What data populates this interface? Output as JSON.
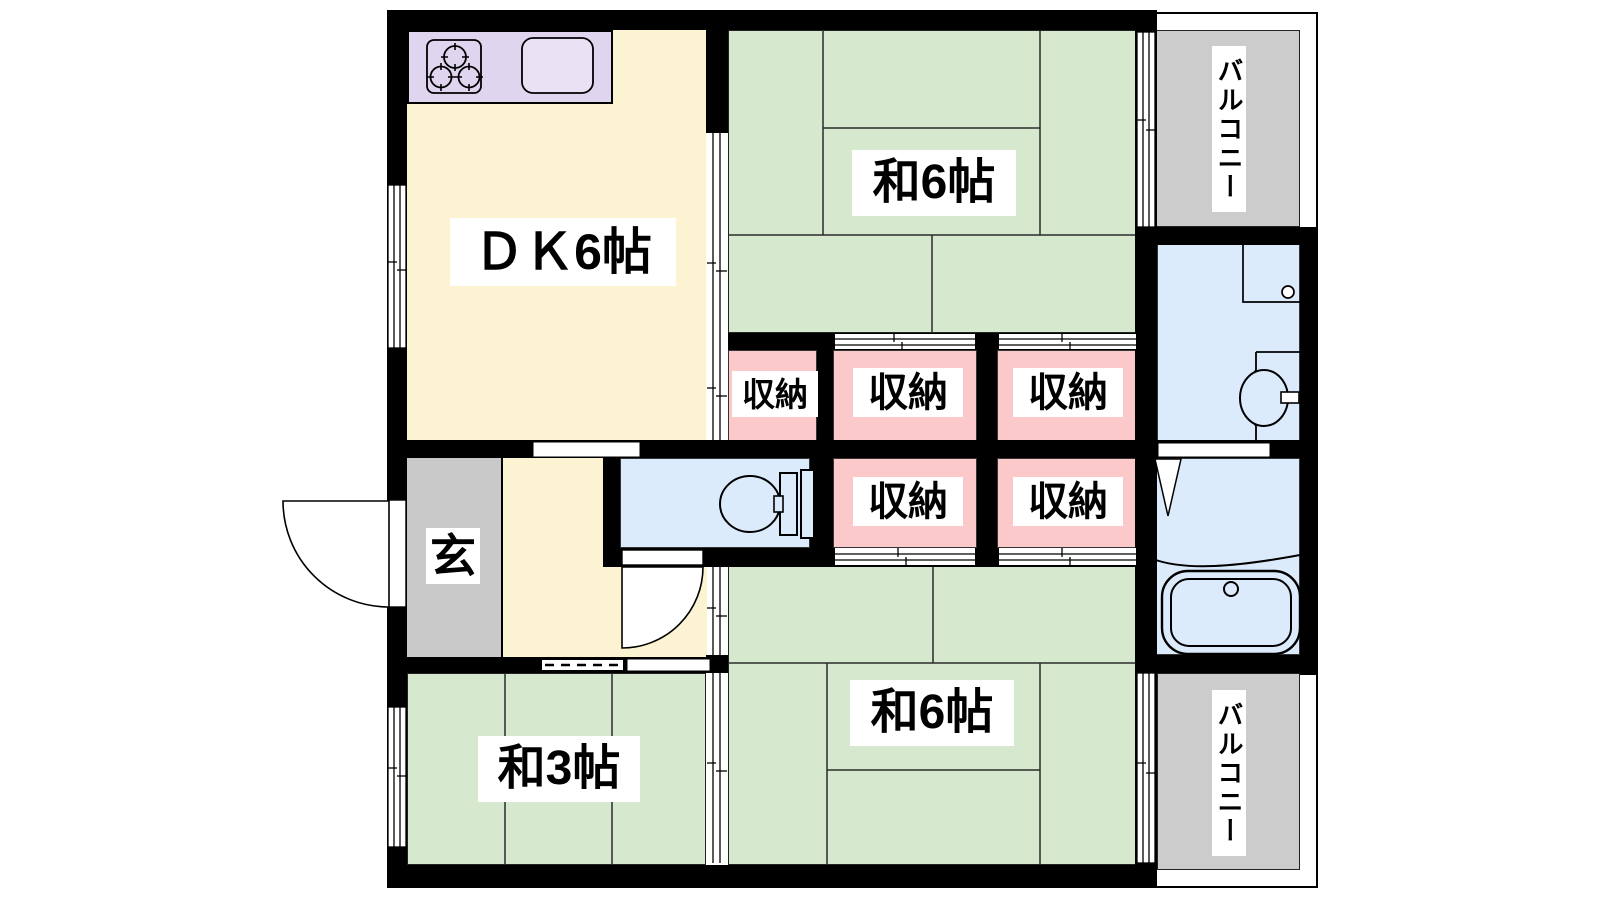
{
  "plan": {
    "title": "2DK apartment floor plan",
    "rooms": {
      "dk": "ＤＫ6帖",
      "wa6_top": "和6帖",
      "wa6_bottom": "和6帖",
      "wa3": "和3帖",
      "genkan": "玄",
      "balcony_top": "バルコニー",
      "balcony_bottom": "バルコニー",
      "storages": [
        "収納",
        "収納",
        "収納",
        "収納",
        "収納"
      ]
    },
    "fixtures": [
      "stove-3-burner",
      "kitchen-sink",
      "toilet",
      "washbasin",
      "washing-machine-pan",
      "bathtub",
      "entrance-door-swing",
      "toilet-door-swing",
      "folding-bath-door"
    ],
    "colors": {
      "tatami_green": "#d6e9cf",
      "room_cream": "#fcf3d3",
      "storage_pink": "#fbc9c9",
      "water_blue": "#dcebfb",
      "kitchen_lavender": "#e0d5ef",
      "balcony_gray": "#cccccc",
      "wall_black": "#000000"
    }
  }
}
